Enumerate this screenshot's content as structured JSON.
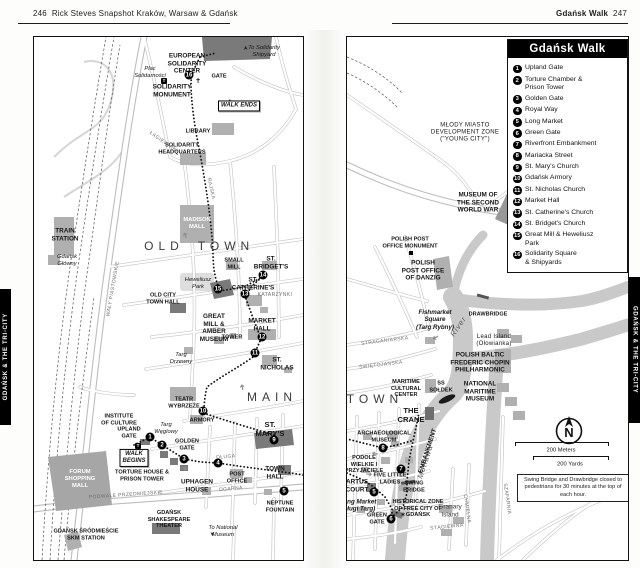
{
  "header": {
    "left": {
      "page_number": "246",
      "title": "Rick Steves Snapshot Kraków, Warsaw & Gdańsk"
    },
    "right": {
      "title": "Gdańsk Walk",
      "page_number": "247"
    }
  },
  "side_tabs": {
    "left": "GDAŃSK & THE TRI-CITY",
    "right": "GDAŃSK & THE TRI-CITY"
  },
  "legend": {
    "title": "Gdańsk Walk",
    "items": [
      {
        "num": "1",
        "label": "Upland Gate"
      },
      {
        "num": "2",
        "label": "Torture Chamber &\nPrison Tower"
      },
      {
        "num": "3",
        "label": "Golden Gate"
      },
      {
        "num": "4",
        "label": "Royal Way"
      },
      {
        "num": "5",
        "label": "Long Market"
      },
      {
        "num": "6",
        "label": "Green Gate"
      },
      {
        "num": "7",
        "label": "Riverfront Embankment"
      },
      {
        "num": "8",
        "label": "Mariacka Street"
      },
      {
        "num": "9",
        "label": "St. Mary's Church"
      },
      {
        "num": "10",
        "label": "Gdańsk Armory"
      },
      {
        "num": "11",
        "label": "St. Nicholas Church"
      },
      {
        "num": "12",
        "label": "Market Hall"
      },
      {
        "num": "13",
        "label": "St. Catherine's Church"
      },
      {
        "num": "14",
        "label": "St. Bridget's Church"
      },
      {
        "num": "15",
        "label": "Great Mill & Heweliusz\nPark"
      },
      {
        "num": "16",
        "label": "Solidarity Square\n& Shipyards"
      }
    ]
  },
  "compass": {
    "label": "N"
  },
  "scale": {
    "meters": "200 Meters",
    "yards": "200 Yards"
  },
  "note": "Swing Bridge and Drawbridge closed to pedestrians for 30 minutes at the top of each hour.",
  "maps": {
    "left": {
      "labels": [
        {
          "t": "EUROPEAN\nSOLIDARITY\nCENTER",
          "x": 153,
          "y": 27,
          "c": "b7"
        },
        {
          "t": "To Solidarity\nShipyard",
          "x": 230,
          "y": 15,
          "c": "it"
        },
        {
          "t": "➤",
          "x": 213,
          "y": 11,
          "c": "arr",
          "r": -90
        },
        {
          "t": "Plac\nSolidarności",
          "x": 116,
          "y": 36,
          "c": "it"
        },
        {
          "t": "T",
          "x": 130,
          "y": 44,
          "c": "tic"
        },
        {
          "t": "GATE",
          "x": 185,
          "y": 40,
          "c": "tiny"
        },
        {
          "t": "✝",
          "x": 164,
          "y": 45,
          "c": "star"
        },
        {
          "t": "SOLIDARITY\nMONUMENT",
          "x": 138,
          "y": 54,
          "c": "b7"
        },
        {
          "t": "WALK ENDS",
          "x": 205,
          "y": 69,
          "c": "box"
        },
        {
          "t": "LIBRARY",
          "x": 164,
          "y": 95,
          "c": "tiny"
        },
        {
          "t": "SOLIDARITY\nHEADQUARTERS",
          "x": 148,
          "y": 112,
          "c": "tiny"
        },
        {
          "t": "MADISON\nMALL",
          "x": 163,
          "y": 187,
          "c": "wt"
        },
        {
          "t": "TRAIN\nSTATION",
          "x": 31,
          "y": 198,
          "c": "b7"
        },
        {
          "t": "Gdańsk\nGłówny",
          "x": 33,
          "y": 224,
          "c": "it"
        },
        {
          "t": "OLD",
          "x": 130,
          "y": 209,
          "c": "sp"
        },
        {
          "t": "TOWN",
          "x": 192,
          "y": 209,
          "c": "sp"
        },
        {
          "t": "Heweliusz\nPark",
          "x": 164,
          "y": 247,
          "c": "it"
        },
        {
          "t": "SMALL\nMILL",
          "x": 200,
          "y": 227,
          "c": "tiny"
        },
        {
          "t": "ST.\nBRIDGET'S",
          "x": 237,
          "y": 226,
          "c": "b7"
        },
        {
          "t": "ST.\nCATHERINE'S",
          "x": 219,
          "y": 247,
          "c": "b7"
        },
        {
          "t": "KATARZYNKI",
          "x": 241,
          "y": 259,
          "c": "st"
        },
        {
          "t": "OLD CITY\nTOWN HALL",
          "x": 129,
          "y": 262,
          "c": "tiny"
        },
        {
          "t": "GREAT\nMILL &\nAMBER\nMUSEUM",
          "x": 180,
          "y": 291,
          "c": "b7"
        },
        {
          "t": "MARKET\nHALL",
          "x": 228,
          "y": 288,
          "c": "b7"
        },
        {
          "t": "TOWER",
          "x": 198,
          "y": 301,
          "c": "tiny"
        },
        {
          "t": "ST.\nNICHOLAS",
          "x": 243,
          "y": 327,
          "c": "b7"
        },
        {
          "t": "MAIN",
          "x": 238,
          "y": 360,
          "c": "sp"
        },
        {
          "t": "Targ\nDrzewny",
          "x": 147,
          "y": 322,
          "c": "it"
        },
        {
          "t": "TEATR\nWYBRZEŻE",
          "x": 150,
          "y": 366,
          "c": "tiny"
        },
        {
          "t": "ARMORY",
          "x": 168,
          "y": 384,
          "c": "tiny"
        },
        {
          "t": "Targ\nWęglowy",
          "x": 132,
          "y": 392,
          "c": "it"
        },
        {
          "t": "INSTITUTE\nOF CULTURE",
          "x": 85,
          "y": 383,
          "c": "tiny"
        },
        {
          "t": "UPLAND\nGATE",
          "x": 95,
          "y": 396,
          "c": "tiny"
        },
        {
          "t": "T",
          "x": 104,
          "y": 409,
          "c": "tic"
        },
        {
          "t": "GOLDEN\nGATE",
          "x": 153,
          "y": 408,
          "c": "tiny"
        },
        {
          "t": "WALK\nBEGINS",
          "x": 100,
          "y": 421,
          "c": "box"
        },
        {
          "t": "TORTURE HOUSE &\nPRISON TOWER",
          "x": 108,
          "y": 439,
          "c": "tiny"
        },
        {
          "t": "UPHAGEN\nHOUSE",
          "x": 163,
          "y": 449,
          "c": "b7"
        },
        {
          "t": "ST. MARY'S",
          "x": 236,
          "y": 393,
          "c": "b8"
        },
        {
          "t": "TOWN\nHALL",
          "x": 241,
          "y": 436,
          "c": "b7"
        },
        {
          "t": "POST\nOFFICE",
          "x": 203,
          "y": 441,
          "c": "tiny"
        },
        {
          "t": "NEPTUNE\nFOUNTAIN",
          "x": 246,
          "y": 470,
          "c": "tiny"
        },
        {
          "t": "GDAŃSK\nSHAKESPEARE\nTHEATER",
          "x": 135,
          "y": 483,
          "c": "tiny"
        },
        {
          "t": "To National\nMuseum",
          "x": 189,
          "y": 495,
          "c": "it"
        },
        {
          "t": "➤",
          "x": 177,
          "y": 497,
          "c": "arr",
          "r": 90
        },
        {
          "t": "FORUM\nSHOPPING\nMALL",
          "x": 46,
          "y": 442,
          "c": "wt"
        },
        {
          "t": "GDAŃSK ŚRÓDMIEŚCIE\nSKM STATION",
          "x": 52,
          "y": 498,
          "c": "tiny"
        },
        {
          "t": "RAJSKA",
          "x": 176,
          "y": 152,
          "c": "st",
          "r": 78
        },
        {
          "t": "ŁAGIEWNIKI",
          "x": 129,
          "y": 106,
          "c": "st",
          "r": 35
        },
        {
          "t": "WAŁY PIASTOWSKIE",
          "x": 80,
          "y": 252,
          "c": "st",
          "r": -80
        },
        {
          "t": "PODWALE PRZEDMIEJSKIE",
          "x": 92,
          "y": 459,
          "c": "st",
          "r": -4
        },
        {
          "t": "DŁUGA",
          "x": 192,
          "y": 421,
          "c": "st",
          "r": -5
        },
        {
          "t": "OGARNA",
          "x": 197,
          "y": 453,
          "c": "st",
          "r": -5
        },
        {
          "t": "➔",
          "x": 152,
          "y": 198,
          "c": "rar",
          "r": -115
        },
        {
          "t": "➔",
          "x": 209,
          "y": 350,
          "c": "rar",
          "r": -100
        },
        {
          "t": "➔",
          "x": 150,
          "y": 432,
          "c": "rar",
          "r": 15
        }
      ],
      "markers": [
        {
          "v": "16",
          "x": 155,
          "y": 38
        },
        {
          "v": "15",
          "x": 184,
          "y": 252
        },
        {
          "v": "14",
          "x": 229,
          "y": 238
        },
        {
          "v": "13",
          "x": 211,
          "y": 257
        },
        {
          "v": "12",
          "x": 228,
          "y": 300
        },
        {
          "v": "11",
          "x": 221,
          "y": 316
        },
        {
          "v": "10",
          "x": 169,
          "y": 374
        },
        {
          "v": "9",
          "x": 240,
          "y": 403
        },
        {
          "v": "1",
          "x": 116,
          "y": 400
        },
        {
          "v": "2",
          "x": 128,
          "y": 408
        },
        {
          "v": "3",
          "x": 150,
          "y": 422
        },
        {
          "v": "4",
          "x": 184,
          "y": 426
        },
        {
          "v": "5",
          "x": 250,
          "y": 454
        }
      ]
    },
    "right": {
      "labels": [
        {
          "t": "MŁODY MIASTO\nDEVELOPMENT ZONE\n(\"YOUNG CITY\")",
          "x": 118,
          "y": 96,
          "c": "tinyn"
        },
        {
          "t": "MUSEUM OF\nTHE SECOND\nWORLD WAR",
          "x": 131,
          "y": 166,
          "c": "b7"
        },
        {
          "t": "POLISH POST\nOFFICE MONUMENT",
          "x": 63,
          "y": 206,
          "c": "tiny"
        },
        {
          "t": "POLISH\nPOST OFFICE\nOF DANZIG",
          "x": 76,
          "y": 234,
          "c": "b7"
        },
        {
          "t": "Fishmarket\nSquare\n(Targ Rybny)",
          "x": 88,
          "y": 283,
          "c": "itb"
        },
        {
          "t": "DRAWBRIDGE",
          "x": 141,
          "y": 278,
          "c": "tiny"
        },
        {
          "t": "Lead Island\n(Ołowianka)",
          "x": 147,
          "y": 304,
          "c": "tinyn"
        },
        {
          "t": "River",
          "x": 112,
          "y": 290,
          "c": "itr",
          "r": -55
        },
        {
          "t": "Motława",
          "x": 79,
          "y": 425,
          "c": "itr",
          "r": -72
        },
        {
          "t": "POLISH BALTIC\nFREDERIC CHOPIN\nPHILHARMONIC",
          "x": 133,
          "y": 326,
          "c": "b7"
        },
        {
          "t": "NATIONAL\nMARITIME\nMUSEUM",
          "x": 133,
          "y": 355,
          "c": "b7"
        },
        {
          "t": "MARITIME\nCULTURAL\nCENTER",
          "x": 59,
          "y": 352,
          "c": "tiny"
        },
        {
          "t": "SS\nSOŁDEK",
          "x": 94,
          "y": 350,
          "c": "tiny"
        },
        {
          "t": "TOWN",
          "x": 28,
          "y": 362,
          "c": "sp"
        },
        {
          "t": "THE\nCRANE",
          "x": 64,
          "y": 379,
          "c": "b8"
        },
        {
          "t": "EMBANKMENT",
          "x": 81,
          "y": 414,
          "c": "b7",
          "r": -72
        },
        {
          "t": "ARCHAEOLOGICAL\nMUSEUM",
          "x": 37,
          "y": 400,
          "c": "tiny"
        },
        {
          "t": "PODOLE\nWIELKIE I\nPRZYJACIELE",
          "x": 17,
          "y": 428,
          "c": "tiny"
        },
        {
          "t": "FIVE LITTLE\nLADIES",
          "x": 43,
          "y": 442,
          "c": "tiny"
        },
        {
          "t": "ARTUS\nCOURT",
          "x": 10,
          "y": 449,
          "c": "b7"
        },
        {
          "t": "Long Market\n(Długi Targ)",
          "x": 11,
          "y": 469,
          "c": "itb"
        },
        {
          "t": "GREEN\nGATE",
          "x": 30,
          "y": 482,
          "c": "tiny"
        },
        {
          "t": "SWING\nBRIDGE",
          "x": 67,
          "y": 450,
          "c": "tiny"
        },
        {
          "t": "HISTORICAL ZONE\nOF FREE CITY OF\nGDAŃSK",
          "x": 71,
          "y": 472,
          "c": "tiny"
        },
        {
          "t": "✶",
          "x": 56,
          "y": 479,
          "c": "star"
        },
        {
          "t": "Granary\nIsland",
          "x": 103,
          "y": 474,
          "c": "gi"
        },
        {
          "t": "STĄGIEWNA",
          "x": 100,
          "y": 491,
          "c": "st",
          "r": -6
        },
        {
          "t": "SZAFARNIA",
          "x": 159,
          "y": 462,
          "c": "st",
          "r": 82
        },
        {
          "t": "CHMIELNA",
          "x": 119,
          "y": 472,
          "c": "st",
          "r": 82
        },
        {
          "t": "STRAGANIARSKA",
          "x": 38,
          "y": 305,
          "c": "st",
          "r": -7
        },
        {
          "t": "ŚWIĘTOJAŃSKA",
          "x": 34,
          "y": 329,
          "c": "st",
          "r": -7
        },
        {
          "t": "➔",
          "x": 22,
          "y": 438,
          "c": "rar",
          "r": 5
        },
        {
          "t": "➔",
          "x": 88,
          "y": 300,
          "c": "rar",
          "r": 150
        },
        {
          "t": "➔",
          "x": 28,
          "y": 416,
          "c": "rar",
          "r": 180
        }
      ],
      "markers": [
        {
          "v": "8",
          "x": 36,
          "y": 411
        },
        {
          "v": "7",
          "x": 54,
          "y": 432
        },
        {
          "v": "5",
          "x": 27,
          "y": 455
        },
        {
          "v": "6",
          "x": 44,
          "y": 482
        }
      ]
    }
  }
}
